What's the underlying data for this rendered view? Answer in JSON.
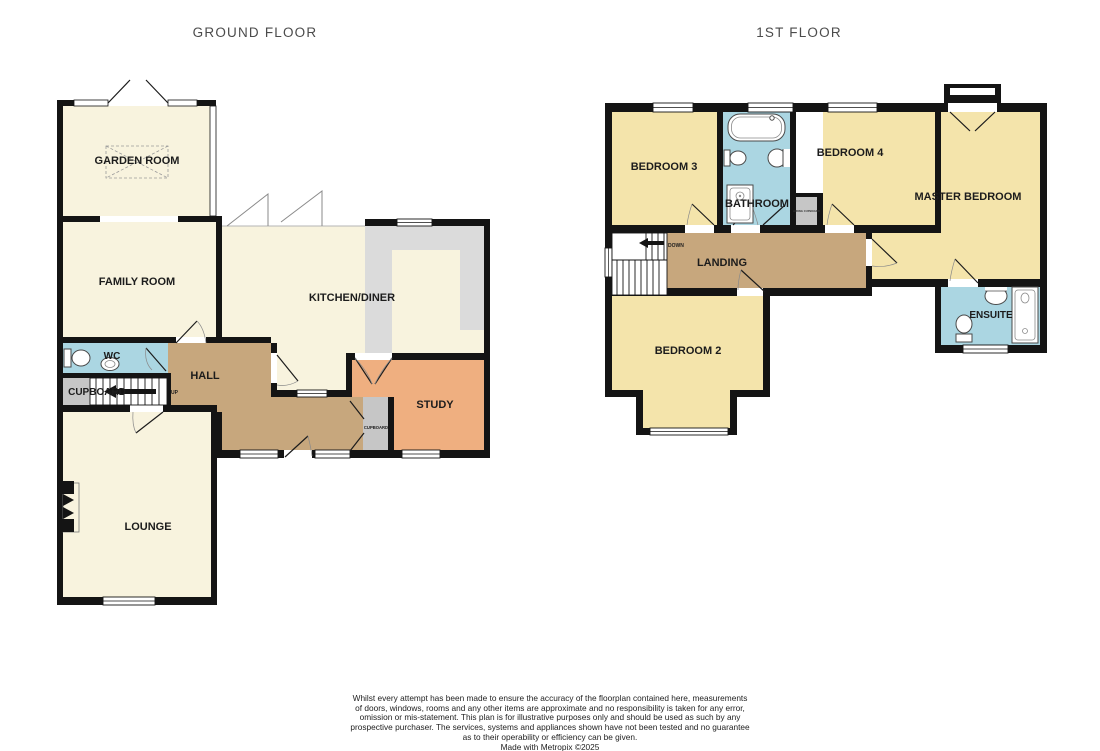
{
  "floors": {
    "ground": {
      "title": "GROUND FLOOR",
      "rooms": {
        "garden_room": "GARDEN ROOM",
        "family_room": "FAMILY ROOM",
        "kitchen_diner": "KITCHEN/DINER",
        "wc": "WC",
        "cupboard": "CUPBOARD",
        "hall": "HALL",
        "study": "STUDY",
        "cupboard_small": "CUPBOARD",
        "lounge": "LOUNGE",
        "stairs_direction": "UP"
      }
    },
    "first": {
      "title": "1ST FLOOR",
      "rooms": {
        "bedroom3": "BEDROOM 3",
        "bathroom": "BATHROOM",
        "bedroom4": "BEDROOM 4",
        "master_bedroom": "MASTER BEDROOM",
        "landing": "LANDING",
        "bedroom2": "BEDROOM 2",
        "ensuite": "ENSUITE",
        "airing_cupboard": "AIRING CUPBOARD",
        "stairs_direction": "DOWN"
      }
    }
  },
  "colors": {
    "wall": "#141414",
    "ground_room": "#F8F3DE",
    "bedroom": "#F4E4AB",
    "hall_landing": "#C7A77D",
    "wet_room": "#ABD6E2",
    "study": "#EFAF80",
    "cupboard": "#C6C6C6",
    "kitchen_counter": "#DBDBDB"
  },
  "footer": {
    "lines": [
      "Whilst every attempt has been made to ensure the accuracy of the floorplan contained here, measurements",
      "of doors, windows, rooms and any other items are approximate and no responsibility is taken for any error,",
      "omission or mis-statement. This plan is for illustrative purposes only and should be used as such by any",
      "prospective purchaser. The services, systems and appliances shown have not been tested and no guarantee",
      "as to their operability or efficiency can be given."
    ],
    "credit": "Made with Metropix ©2025"
  }
}
